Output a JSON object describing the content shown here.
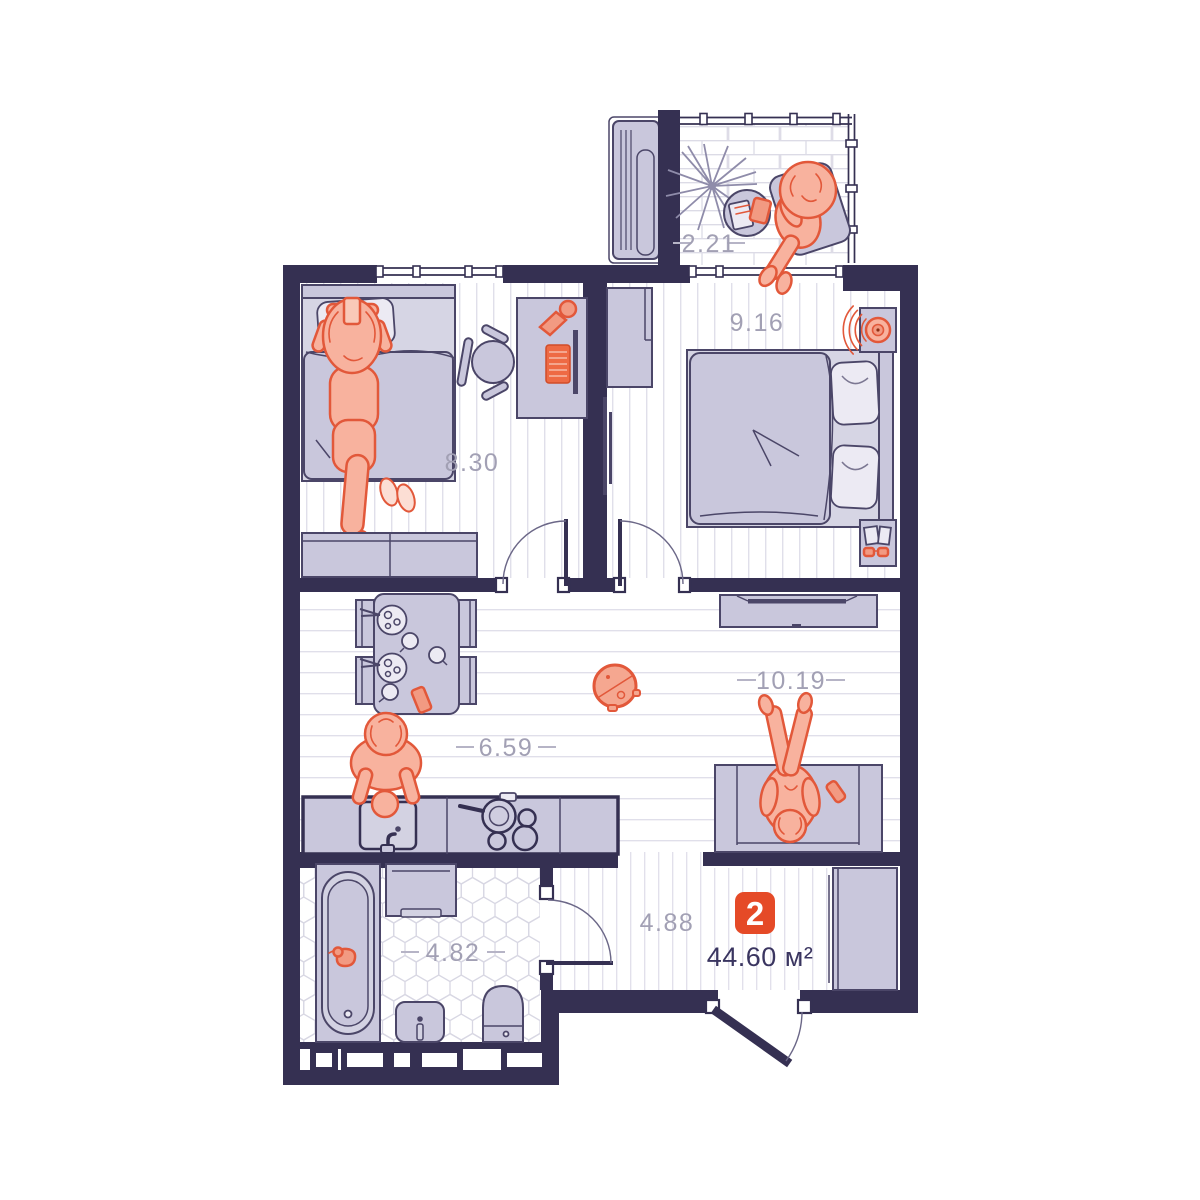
{
  "plan": {
    "unit_badge": "2",
    "total_area_label": "44.60 м²",
    "rooms": [
      {
        "id": "balcony",
        "area": "2.21"
      },
      {
        "id": "bedroom-left",
        "area": "8.30"
      },
      {
        "id": "bedroom-right",
        "area": "9.16"
      },
      {
        "id": "living-room",
        "area": "10.19"
      },
      {
        "id": "kitchen-dining",
        "area": "6.59"
      },
      {
        "id": "hallway",
        "area": "4.88"
      },
      {
        "id": "bathroom",
        "area": "4.82"
      }
    ],
    "colors": {
      "wall": "#353052",
      "furniture": "#c9c7dc",
      "accent": "#e54a27",
      "person": "#f8b29e",
      "room_label": "#a2a0b4"
    }
  }
}
